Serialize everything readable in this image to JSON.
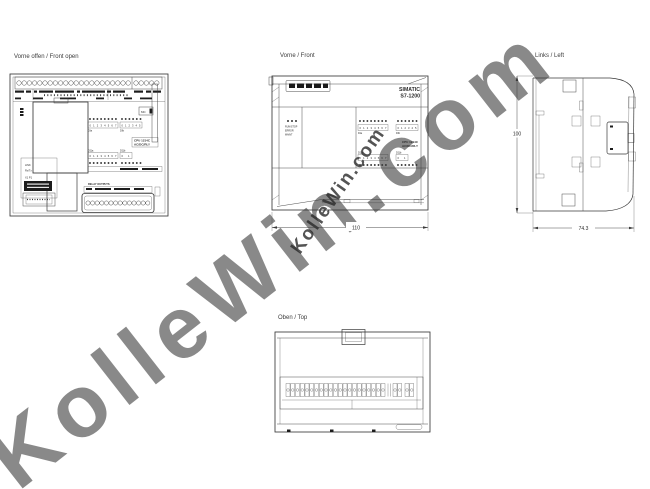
{
  "watermark": {
    "text": "KolleWin.com",
    "color_large": "#c7c7c7",
    "color_medium": "#9b9b9b"
  },
  "colors": {
    "line": "#3a3a3a",
    "background": "#ffffff"
  },
  "views": {
    "front_open": {
      "title": "Vorne offen / Front open"
    },
    "front": {
      "title": "Vorne / Front"
    },
    "left": {
      "title": "Links / Left"
    },
    "top": {
      "title": "Oben / Top"
    }
  },
  "device": {
    "brand_line1": "SIMATIC",
    "brand_line2": "S7-1200",
    "cpu_line1": "CPU 1214C",
    "cpu_line2": "AC/DC/RLY",
    "status_leds": {
      "run_stop": "RUN/STOP",
      "error": "ERROR",
      "maint": "MAINT"
    },
    "io": {
      "di_a": {
        "label": "DIa",
        "digits": "0 1 2 3 4 5 6 7"
      },
      "di_b": {
        "label": "DIb",
        "digits": "0 1 2 3 4 5"
      },
      "dq_a": {
        "label": "DQa",
        "digits": "0 1 2 3 4 5 6 7"
      },
      "dq_b": {
        "label": "DQb",
        "digits": "0 1"
      }
    },
    "ports": {
      "link": "LINK",
      "rxtx": "Rx/Tx",
      "x1p1": "X1 P1",
      "memory_card": "MC"
    },
    "relay_outputs": "RELAY OUTPUTS"
  },
  "dimensions": {
    "front_width": "110",
    "side_height": "100",
    "side_depth": "74.3"
  }
}
